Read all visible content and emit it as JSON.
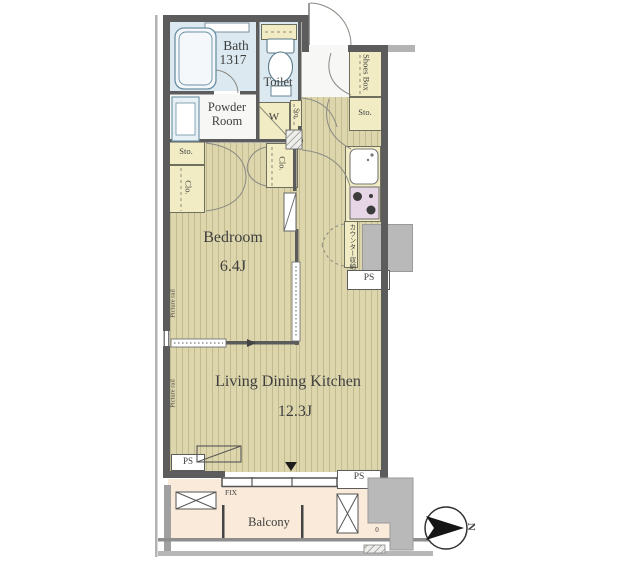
{
  "plan": {
    "rooms": {
      "bath": {
        "name": "Bath",
        "size": "1317"
      },
      "toilet": {
        "name": "Toilet"
      },
      "powder_room": {
        "name_line1": "Powder",
        "name_line2": "Room"
      },
      "washing_machine": {
        "label": "W"
      },
      "bedroom": {
        "name": "Bedroom",
        "area": "6.4J"
      },
      "living_dining_kitchen": {
        "name": "Living Dining Kitchen",
        "area": "12.3J"
      },
      "balcony": {
        "name": "Balcony"
      }
    },
    "storage_labels": {
      "shoes_box": "Shoes Box",
      "entrance_storage": "Sto.",
      "hall_storage": "Sto.",
      "bedroom_storage": "Sto.",
      "bedroom_closet_left": "Clo.",
      "bedroom_closet_right": "Clo.",
      "counter_storage": "カウンター収納"
    },
    "annotations": {
      "pipe_space": "PS",
      "fixed_window": "FIX",
      "picture_rail": "Picture rail",
      "north": "N",
      "drain": "0"
    },
    "palette": {
      "wall": "#5c5c5c",
      "flooring": "#ddd6ac",
      "wet_area": "#dce9f0",
      "storage": "#f1ecc3",
      "balcony": "#f9ead9",
      "exterior_gray": "#b9b9b9",
      "stove": "#e6d6e6",
      "text": "#3f3f3f"
    }
  }
}
